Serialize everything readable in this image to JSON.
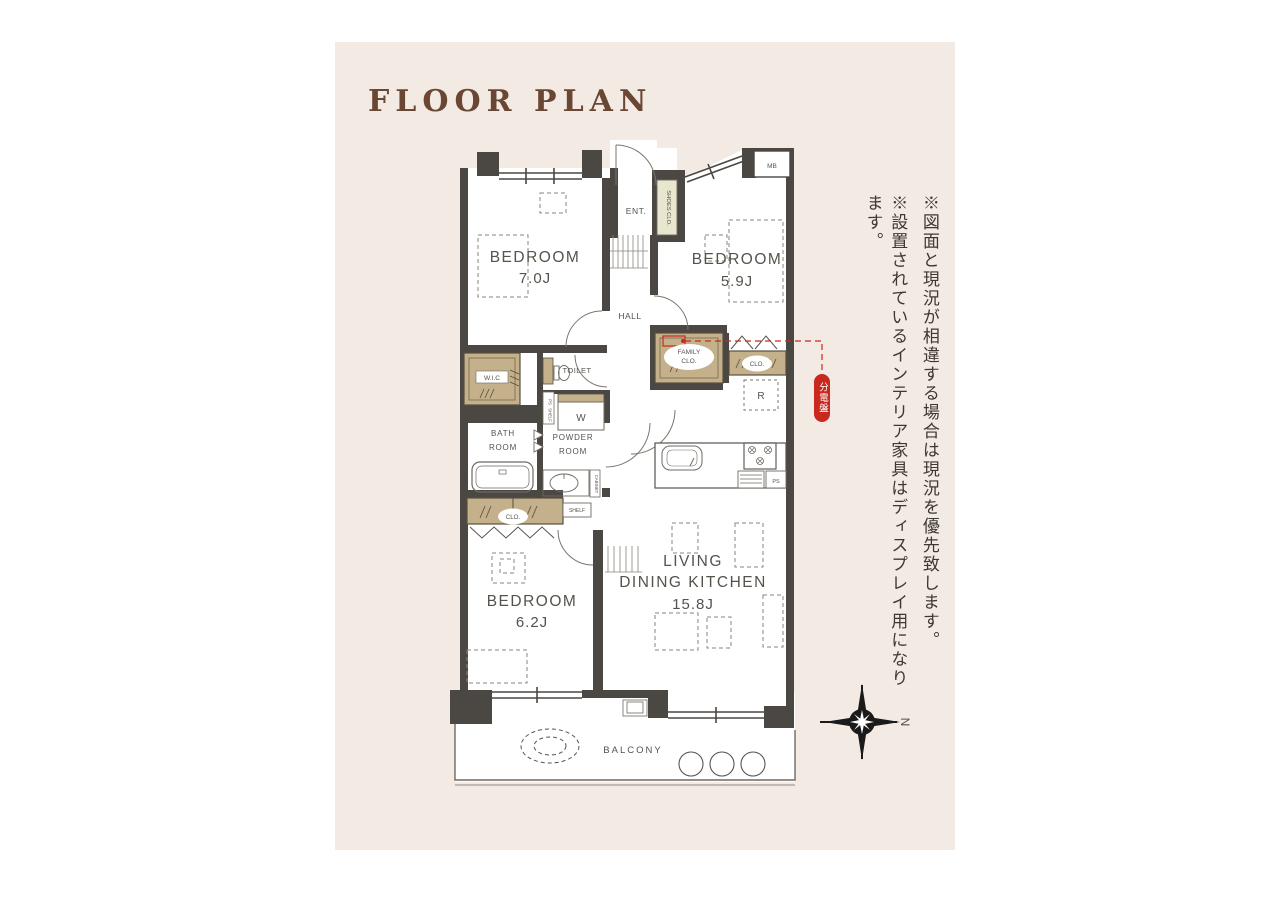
{
  "page": {
    "title": "FLOOR PLAN"
  },
  "notes": {
    "note1": "※図面と現況が相違する場合は現況を優先致します。",
    "note2": "※設置されているインテリア家具はディスプレイ用になります。"
  },
  "compass": {
    "north_label": "N"
  },
  "colors": {
    "panel_bg": "#f3ebe3",
    "wall": "#4b4742",
    "closet_tan": "#c4b08a",
    "shoes_closet": "#e9e6cf",
    "accent_red": "#c9281f",
    "title_brown": "#6a4733"
  },
  "rooms": {
    "bedroom1": {
      "name": "BEDROOM",
      "size": "7.0J"
    },
    "bedroom2": {
      "name": "BEDROOM",
      "size": "5.9J"
    },
    "bedroom3": {
      "name": "BEDROOM",
      "size": "6.2J"
    },
    "ldk": {
      "name_line1": "LIVING",
      "name_line2": "DINING KITCHEN",
      "size": "15.8J"
    },
    "balcony": {
      "name": "BALCONY"
    },
    "hall": {
      "name": "HALL"
    },
    "entrance": {
      "name": "ENT."
    },
    "toilet": {
      "name": "TOILET"
    },
    "bathroom": {
      "name_line1": "BATH",
      "name_line2": "ROOM"
    },
    "powder_room": {
      "name_line1": "POWDER",
      "name_line2": "ROOM"
    },
    "wic": {
      "name": "W.I.C"
    },
    "family_closet": {
      "name_line1": "FAMILY",
      "name_line2": "CLO."
    },
    "closet_right": {
      "name": "CLO."
    },
    "closet_bottom": {
      "name": "CLO."
    },
    "shoes_closet": {
      "name": "SHOES CLO."
    }
  },
  "fixtures": {
    "washer": "W",
    "refrigerator": "R",
    "meter_box": "MB",
    "pipe_space_strip": "PS",
    "pipe_space_kitchen": "PS",
    "shelf_strip": "SHELF",
    "shelf_box": "SHELF",
    "cabinet": "CABINET",
    "distribution_board": "分電盤"
  }
}
